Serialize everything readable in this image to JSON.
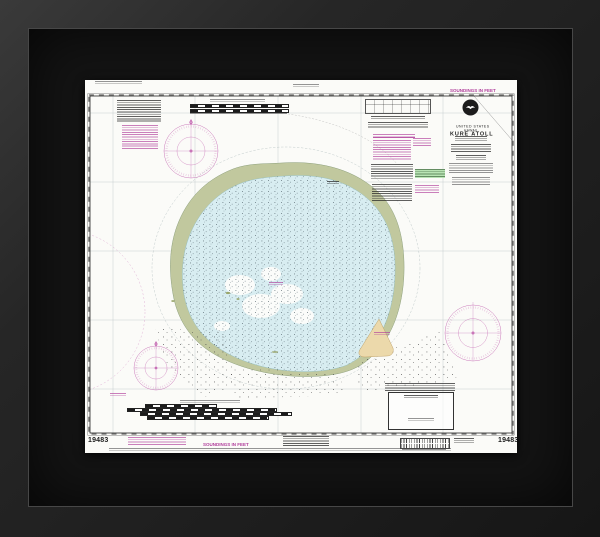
{
  "chart": {
    "title": "KURE ATOLL",
    "region": {
      "line1": "UNITED STATES",
      "line2": "HAWAII"
    },
    "soundings_top": "SOUNDINGS IN FEET",
    "soundings_bottom": "SOUNDINGS IN FEET",
    "chart_number_left": "19483",
    "chart_number_right": "19483",
    "icons": {
      "noaa_logo": "noaa-logo-icon",
      "compass_rose": "compass-rose-icon"
    },
    "colors": {
      "magenta": "#b03e9b",
      "reef": "#c1c89e",
      "lagoon": "#d8edf1",
      "sand_island": "#ecd9ab",
      "note_highlight_green": "#b9e4b4",
      "paper": "#fbfbf8",
      "frame": "#2b2b2b",
      "mat": "#141414"
    }
  }
}
